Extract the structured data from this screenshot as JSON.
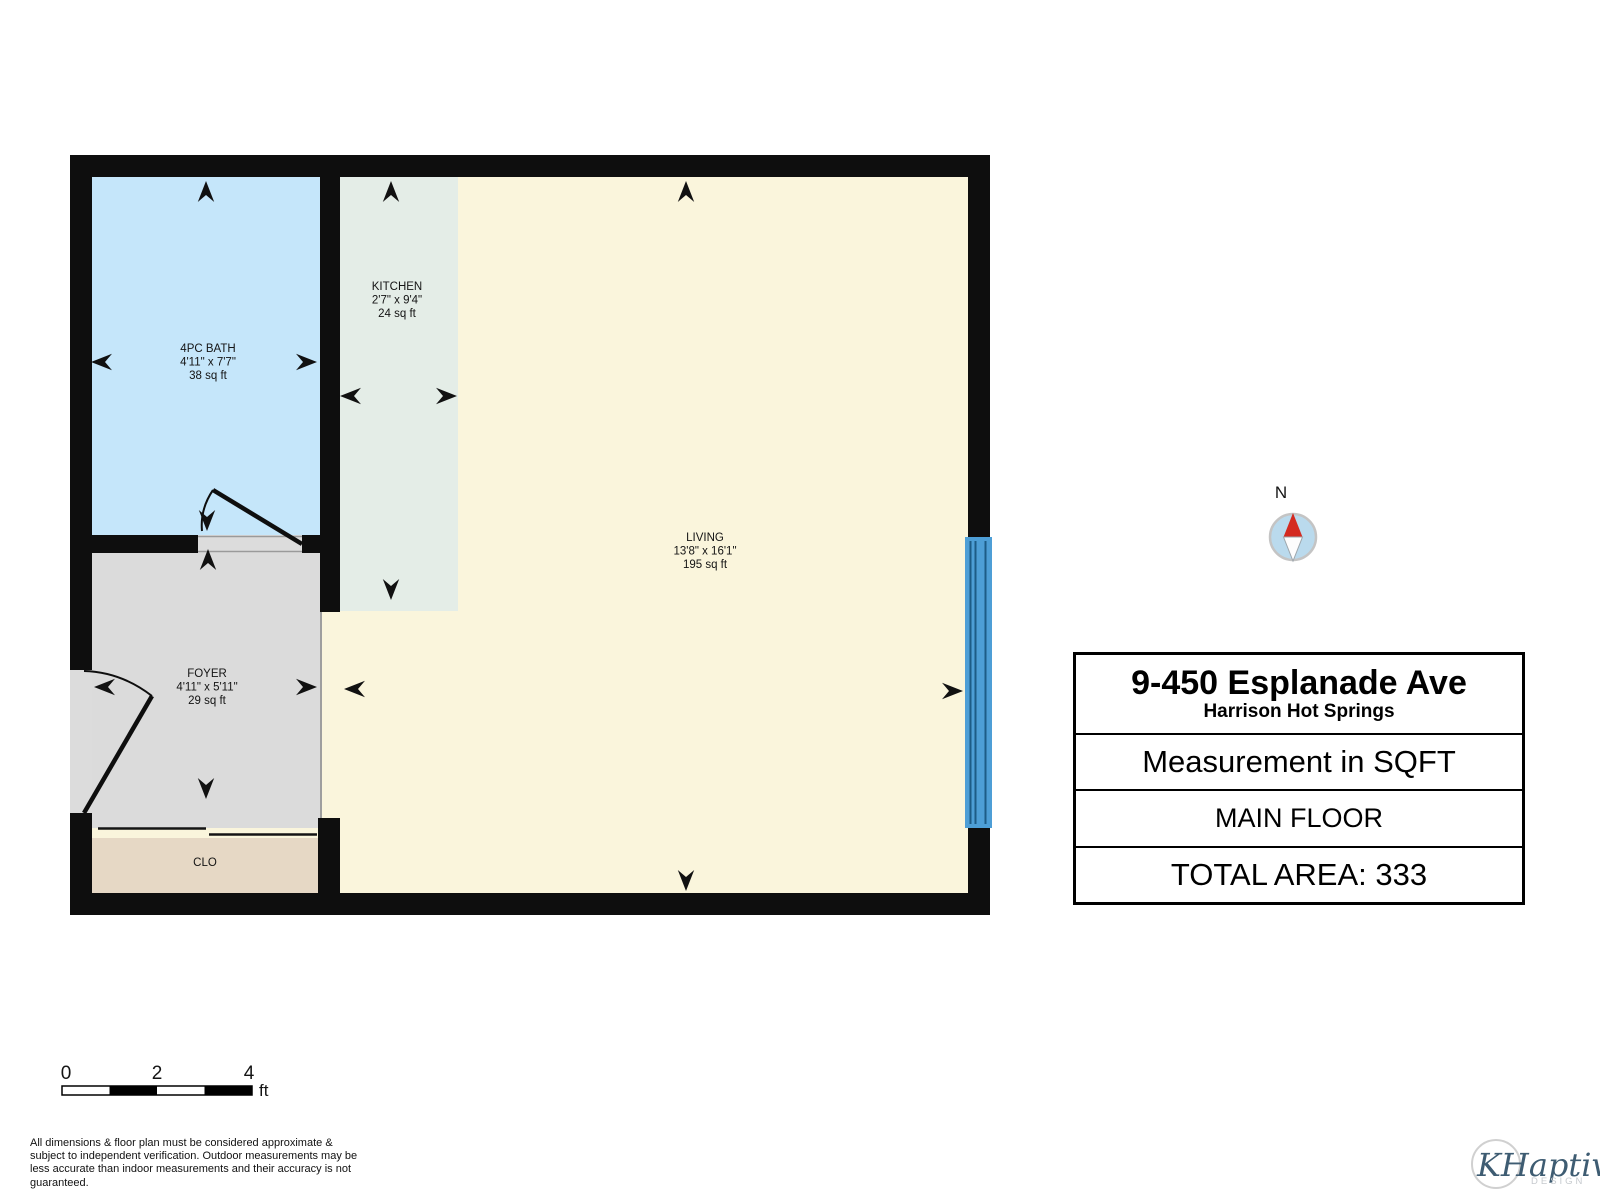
{
  "colors": {
    "wall": "#0E0E0E",
    "bath": "#C5E6FA",
    "kitchen": "#E4EDE7",
    "living": "#FAF5DC",
    "foyer": "#DBDBDB",
    "closet": "#E6D8C5",
    "sill": "#DCDCDC",
    "window": "#4D9ED6",
    "window_line": "#1D5C87",
    "compass_fill": "#BADAED",
    "compass_needle_red": "#D42A20"
  },
  "floor_plan": {
    "rooms": [
      {
        "name": "4PC BATH",
        "dims": "4'11\" x 7'7\"",
        "area": "38 sq ft"
      },
      {
        "name": "KITCHEN",
        "dims": "2'7\" x 9'4\"",
        "area": "24 sq ft"
      },
      {
        "name": "LIVING",
        "dims": "13'8\" x 16'1\"",
        "area": "195 sq ft"
      },
      {
        "name": "FOYER",
        "dims": "4'11\" x 5'11\"",
        "area": "29 sq ft"
      },
      {
        "name": "CLO"
      }
    ]
  },
  "compass": {
    "north_label": "N"
  },
  "info_box": {
    "address": "9-450 Esplanade Ave",
    "city": "Harrison Hot Springs",
    "measurement": "Measurement in SQFT",
    "floor": "MAIN FLOOR",
    "total_area": "TOTAL AREA: 333"
  },
  "scale_bar": {
    "tick0": "0",
    "tick1": "2",
    "tick2": "4",
    "unit": "ft"
  },
  "disclaimer": {
    "line1": "All dimensions & floor plan must be considered approximate &",
    "line2": "subject to independent verification.  Outdoor measurements may be",
    "line3": "less accurate than indoor measurements and their accuracy is not",
    "line4": "guaranteed."
  },
  "logo": {
    "name": "KHaptive",
    "sub": "DESIGN"
  }
}
